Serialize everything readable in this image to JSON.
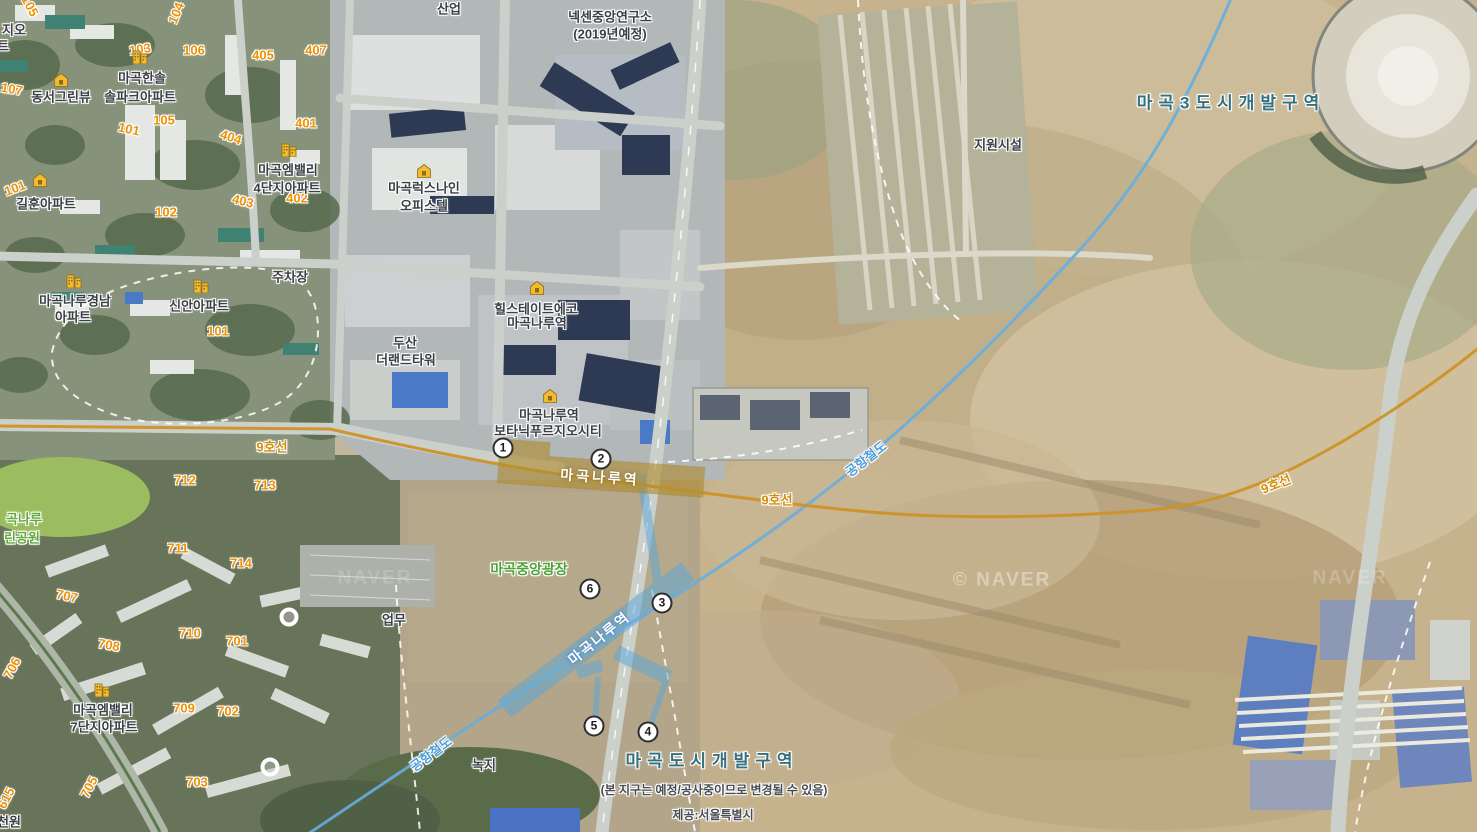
{
  "map": {
    "brand_logo": "NAVER",
    "credit": "제공:서울특별시",
    "colors": {
      "line9": "#cd9227",
      "arex": "#58a7dd",
      "station_box": "#b08d2e",
      "poi_text": "#3b4046",
      "block_number": "#ef9104",
      "zone_text": "#35707f",
      "park_text": "#61a83b",
      "naver_green": "#2dbd2a"
    }
  },
  "station": {
    "box_label": "마곡나루역",
    "exits": [
      {
        "n": "1",
        "x": 503,
        "y": 448
      },
      {
        "n": "2",
        "x": 601,
        "y": 459
      },
      {
        "n": "3",
        "x": 662,
        "y": 603
      },
      {
        "n": "4",
        "x": 648,
        "y": 732
      },
      {
        "n": "5",
        "x": 594,
        "y": 726
      },
      {
        "n": "6",
        "x": 590,
        "y": 589
      }
    ]
  },
  "labels": [
    {
      "text": "105",
      "kind": "num",
      "x": 30,
      "y": 6,
      "rot": 62,
      "name": "block-number-label"
    },
    {
      "text": "지오",
      "kind": "poi",
      "x": 14,
      "y": 30,
      "name": "poi-label-partial"
    },
    {
      "text": "트",
      "kind": "poi",
      "x": 3,
      "y": 46,
      "name": "poi-label-partial"
    },
    {
      "text": "107",
      "kind": "num",
      "x": 12,
      "y": 89,
      "rot": 10,
      "name": "block-number-label"
    },
    {
      "text": "동서그린뷰",
      "kind": "poi",
      "x": 61,
      "y": 97,
      "name": "poi-label"
    },
    {
      "text": "마곡한솔",
      "kind": "poi",
      "x": 142,
      "y": 78,
      "name": "poi-label"
    },
    {
      "text": "솔파크아파트",
      "kind": "poi",
      "x": 140,
      "y": 97,
      "name": "poi-label"
    },
    {
      "text": "103",
      "kind": "num",
      "x": 140,
      "y": 49,
      "rot": -8,
      "name": "block-number-label"
    },
    {
      "text": "104",
      "kind": "num",
      "x": 176,
      "y": 13,
      "rot": -68,
      "name": "block-number-label"
    },
    {
      "text": "106",
      "kind": "num",
      "x": 194,
      "y": 50,
      "name": "block-number-label"
    },
    {
      "text": "405",
      "kind": "num",
      "x": 263,
      "y": 55,
      "name": "block-number-label"
    },
    {
      "text": "407",
      "kind": "num",
      "x": 316,
      "y": 50,
      "name": "block-number-label"
    },
    {
      "text": "101",
      "kind": "num",
      "x": 129,
      "y": 129,
      "rot": 12,
      "name": "block-number-label"
    },
    {
      "text": "105",
      "kind": "num",
      "x": 164,
      "y": 120,
      "name": "block-number-label"
    },
    {
      "text": "404",
      "kind": "num",
      "x": 231,
      "y": 137,
      "rot": 18,
      "name": "block-number-label"
    },
    {
      "text": "401",
      "kind": "num",
      "x": 306,
      "y": 123,
      "name": "block-number-label"
    },
    {
      "text": "403",
      "kind": "num",
      "x": 243,
      "y": 201,
      "rot": 14,
      "name": "block-number-label"
    },
    {
      "text": "402",
      "kind": "num",
      "x": 297,
      "y": 198,
      "name": "block-number-label"
    },
    {
      "text": "102",
      "kind": "num",
      "x": 166,
      "y": 212,
      "name": "block-number-label"
    },
    {
      "text": "101",
      "kind": "num",
      "x": 15,
      "y": 188,
      "rot": -20,
      "name": "block-number-label"
    },
    {
      "text": "길훈아파트",
      "kind": "poi",
      "x": 46,
      "y": 204,
      "name": "poi-label"
    },
    {
      "text": "마곡엠밸리",
      "kind": "poi",
      "x": 288,
      "y": 170,
      "name": "poi-label"
    },
    {
      "text": "4단지아파트",
      "kind": "poi",
      "x": 287,
      "y": 188,
      "name": "poi-label"
    },
    {
      "text": "산업",
      "kind": "poi",
      "x": 449,
      "y": 9,
      "name": "poi-label"
    },
    {
      "text": "넥센중앙연구소",
      "kind": "poi",
      "x": 610,
      "y": 17,
      "name": "poi-label"
    },
    {
      "text": "(2019년예정)",
      "kind": "poi",
      "x": 610,
      "y": 34,
      "name": "poi-label"
    },
    {
      "text": "마곡3도시개발구역",
      "kind": "zone",
      "x": 1231,
      "y": 103,
      "name": "district-zone-label"
    },
    {
      "text": "지원시설",
      "kind": "poi",
      "x": 998,
      "y": 145,
      "name": "poi-label"
    },
    {
      "text": "마곡럭스나인",
      "kind": "poi",
      "x": 424,
      "y": 188,
      "name": "poi-label"
    },
    {
      "text": "오피스텔",
      "kind": "poi",
      "x": 424,
      "y": 206,
      "name": "poi-label"
    },
    {
      "text": "주차장",
      "kind": "poi",
      "x": 290,
      "y": 277,
      "name": "poi-label"
    },
    {
      "text": "마곡나루경남",
      "kind": "poi",
      "x": 75,
      "y": 301,
      "name": "poi-label"
    },
    {
      "text": "아파트",
      "kind": "poi",
      "x": 73,
      "y": 317,
      "name": "poi-label"
    },
    {
      "text": "신안아파트",
      "kind": "poi",
      "x": 199,
      "y": 306,
      "name": "poi-label"
    },
    {
      "text": "101",
      "kind": "num",
      "x": 218,
      "y": 331,
      "name": "block-number-label"
    },
    {
      "text": "힐스테이트에코",
      "kind": "poi",
      "x": 536,
      "y": 309,
      "name": "poi-label"
    },
    {
      "text": "마곡나루역",
      "kind": "poi",
      "x": 537,
      "y": 323,
      "name": "poi-label"
    },
    {
      "text": "두산",
      "kind": "poi",
      "x": 405,
      "y": 343,
      "name": "poi-label"
    },
    {
      "text": "더랜드타워",
      "kind": "poi",
      "x": 406,
      "y": 360,
      "name": "poi-label"
    },
    {
      "text": "마곡나루역",
      "kind": "poi",
      "x": 549,
      "y": 415,
      "name": "poi-label"
    },
    {
      "text": "보타닉푸르지오시티",
      "kind": "poi",
      "x": 548,
      "y": 431,
      "name": "poi-label"
    },
    {
      "text": "마곡나루역",
      "kind": "stationbox",
      "x": 600,
      "y": 477,
      "rot": 4,
      "name": "line9-station-label"
    },
    {
      "text": "9호선",
      "kind": "line9",
      "x": 272,
      "y": 447,
      "name": "subway-line9-label"
    },
    {
      "text": "9호선",
      "kind": "line9",
      "x": 777,
      "y": 500,
      "name": "subway-line9-label"
    },
    {
      "text": "9호선",
      "kind": "line9",
      "x": 1276,
      "y": 484,
      "rot": -22,
      "name": "subway-line9-label"
    },
    {
      "text": "공항철도",
      "kind": "arex",
      "x": 866,
      "y": 459,
      "rot": -38,
      "name": "arex-line-label"
    },
    {
      "text": "마곡나루역",
      "kind": "band",
      "x": 599,
      "y": 638,
      "rot": -39,
      "name": "arex-station-label"
    },
    {
      "text": "공항철도",
      "kind": "arex",
      "x": 431,
      "y": 754,
      "rot": -37,
      "name": "arex-line-label"
    },
    {
      "text": "마곡중앙광장",
      "kind": "green2",
      "x": 529,
      "y": 569,
      "name": "plaza-label"
    },
    {
      "text": "곡나루",
      "kind": "green",
      "x": 24,
      "y": 519,
      "name": "park-label-partial"
    },
    {
      "text": "린공원",
      "kind": "green",
      "x": 22,
      "y": 538,
      "name": "park-label-partial"
    },
    {
      "text": "업무",
      "kind": "poi",
      "x": 394,
      "y": 620,
      "name": "poi-label"
    },
    {
      "text": "녹지",
      "kind": "poi",
      "x": 484,
      "y": 765,
      "name": "poi-label"
    },
    {
      "text": "마곡도시개발구역",
      "kind": "zone",
      "x": 712,
      "y": 761,
      "name": "district-zone-label"
    },
    {
      "text": "(본 지구는 예정/공사중이므로 변경될 수 있음)",
      "kind": "note",
      "x": 714,
      "y": 790,
      "name": "map-note"
    },
    {
      "text": "제공:서울특별시",
      "kind": "note",
      "x": 713,
      "y": 815,
      "name": "map-credit"
    },
    {
      "text": "712",
      "kind": "num",
      "x": 185,
      "y": 480,
      "name": "block-number-label"
    },
    {
      "text": "713",
      "kind": "num",
      "x": 265,
      "y": 485,
      "name": "block-number-label"
    },
    {
      "text": "711",
      "kind": "num",
      "x": 178,
      "y": 548,
      "name": "block-number-label"
    },
    {
      "text": "714",
      "kind": "num",
      "x": 241,
      "y": 563,
      "name": "block-number-label"
    },
    {
      "text": "707",
      "kind": "num",
      "x": 67,
      "y": 596,
      "rot": 12,
      "name": "block-number-label"
    },
    {
      "text": "710",
      "kind": "num",
      "x": 190,
      "y": 633,
      "name": "block-number-label"
    },
    {
      "text": "701",
      "kind": "num",
      "x": 237,
      "y": 641,
      "name": "block-number-label"
    },
    {
      "text": "708",
      "kind": "num",
      "x": 109,
      "y": 645,
      "rot": 10,
      "name": "block-number-label"
    },
    {
      "text": "706",
      "kind": "num",
      "x": 12,
      "y": 668,
      "rot": -62,
      "name": "block-number-label"
    },
    {
      "text": "709",
      "kind": "num",
      "x": 184,
      "y": 708,
      "name": "block-number-label"
    },
    {
      "text": "702",
      "kind": "num",
      "x": 228,
      "y": 711,
      "name": "block-number-label"
    },
    {
      "text": "마곡엠밸리",
      "kind": "poi",
      "x": 103,
      "y": 710,
      "name": "poi-label"
    },
    {
      "text": "7단지아파트",
      "kind": "poi",
      "x": 104,
      "y": 727,
      "name": "poi-label"
    },
    {
      "text": "705",
      "kind": "num",
      "x": 89,
      "y": 787,
      "rot": -62,
      "name": "block-number-label"
    },
    {
      "text": "703",
      "kind": "num",
      "x": 197,
      "y": 782,
      "name": "block-number-label"
    },
    {
      "text": "615",
      "kind": "num",
      "x": 6,
      "y": 798,
      "rot": -62,
      "name": "block-number-label"
    },
    {
      "text": "천원",
      "kind": "poi",
      "x": 9,
      "y": 822,
      "name": "poi-label-partial"
    },
    {
      "text": "© NAVER",
      "kind": "wm",
      "x": 1002,
      "y": 580,
      "op": 0.38,
      "name": "naver-watermark"
    },
    {
      "text": "NAVER",
      "kind": "wm",
      "x": 375,
      "y": 578,
      "op": 0.16,
      "name": "naver-watermark"
    },
    {
      "text": "NAVER",
      "kind": "wm",
      "x": 1350,
      "y": 578,
      "op": 0.22,
      "name": "naver-watermark"
    }
  ],
  "icons": [
    {
      "type": "building-icon",
      "x": 140,
      "y": 57
    },
    {
      "type": "building-icon",
      "x": 289,
      "y": 150
    },
    {
      "type": "building-icon",
      "x": 74,
      "y": 281
    },
    {
      "type": "building-icon",
      "x": 201,
      "y": 286
    },
    {
      "type": "building-icon",
      "x": 102,
      "y": 690
    },
    {
      "type": "house-icon",
      "x": 61,
      "y": 80
    },
    {
      "type": "house-icon",
      "x": 40,
      "y": 180
    },
    {
      "type": "house-icon",
      "x": 537,
      "y": 288
    },
    {
      "type": "house-icon",
      "x": 550,
      "y": 396
    },
    {
      "type": "house-icon",
      "x": 424,
      "y": 171
    },
    {
      "type": "roundabout-icon",
      "x": 289,
      "y": 617
    },
    {
      "type": "roundabout-icon",
      "x": 270,
      "y": 767
    }
  ]
}
